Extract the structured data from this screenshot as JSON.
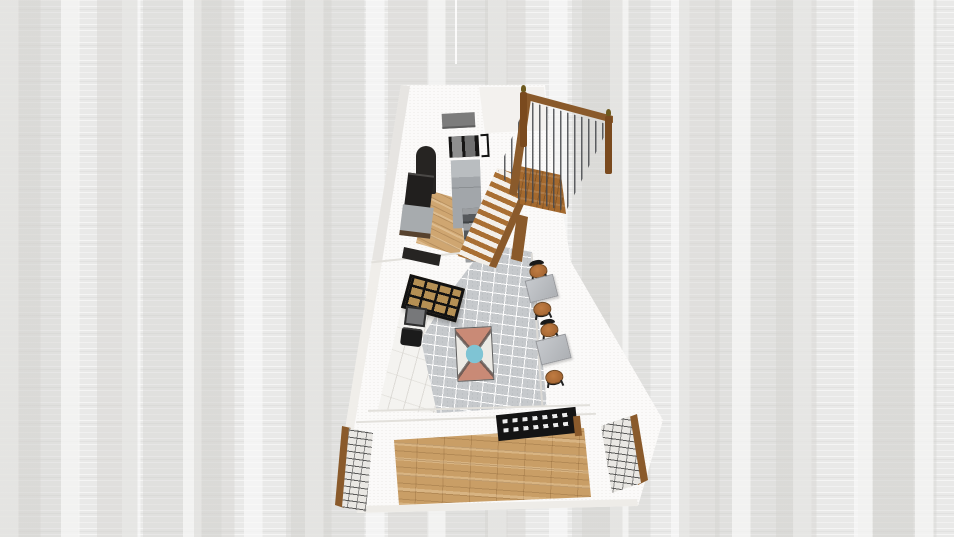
{
  "scene": {
    "title": "3D floor plan render",
    "view": "elevated three-quarter perspective of a narrow two-level unit",
    "rooms": [
      {
        "label": "kitchen"
      },
      {
        "label": "stair hall"
      },
      {
        "label": "dining walkway"
      },
      {
        "label": "entry porch"
      }
    ],
    "colors": {
      "background": "#e9e9e8",
      "building_white": "#fbfaf9",
      "exterior_shadow": "#e7e5e2",
      "exterior_shadow_light": "#f0eeea",
      "back_wall_shade": "#f3f1ee",
      "window_panel_gray": "#7c7c7c",
      "appliance_black": "#161514",
      "cabinet_dark": "#262422",
      "counter_black": "#211f1e",
      "cabinet_gray": "#a7abae",
      "fridge_gray": "#a2a6aa",
      "appliance_counter_gray": "#55585b",
      "kitchen_wood": "#cfa671",
      "stair_tread_wood": "#a96f33",
      "stair_stringer_wood": "#8a5a2b",
      "landing_wood": "#a4692e",
      "rail_wood": "#8a5a2b",
      "newel_wood": "#7a4a1e",
      "finial_bronze": "#6e5a1e",
      "door_glass_tan": "#b59054",
      "door_frame_black": "#121212",
      "console_gray": "#77787a",
      "armchair_black": "#1b1b1b",
      "marble_white": "#f4f3f0",
      "tile_gray": "#c6c9cc",
      "rug_base": "#eceae5",
      "rug_teal": "#7fc4d4",
      "rug_coral": "#c98a76",
      "table_gray": "#bcbfc3",
      "chair_seat_wood": "#ad6d38",
      "chair_back_black": "#191919",
      "entry_wood": "#c99e66",
      "bench_black": "#141414",
      "pillar_brick_fill": "#e9e7e3",
      "pillar_wood_trim": "#8a5a2b"
    },
    "objects": {
      "building": {
        "label": "building footprint"
      },
      "wall_art": {
        "label": "wall panel / window"
      },
      "wall_oven": {
        "label": "wall oven / microwave"
      },
      "oven_bracket": {
        "label": "wall bracket"
      },
      "arched_cabinet": {
        "label": "arched pantry cabinet"
      },
      "kitchen_counter": {
        "label": "dark kitchen counter"
      },
      "base_cabinet": {
        "label": "gray base cabinet"
      },
      "lower_counter": {
        "label": "lower counter run"
      },
      "refrigerator": {
        "label": "refrigerator / tall unit"
      },
      "appliance_counter": {
        "label": "counter with appliances"
      },
      "kitchen_wood_floor": {
        "label": "kitchen wood floor"
      },
      "staircase": {
        "label": "staircase flight"
      },
      "stair_stringer": {
        "label": "stair stringer"
      },
      "landing": {
        "label": "stair landing"
      },
      "railing": {
        "label": "stair railing balusters"
      },
      "top_rail": {
        "label": "handrail"
      },
      "side_rail": {
        "label": "lower handrail"
      },
      "newel_left": {
        "label": "newel post with finial"
      },
      "newel_right": {
        "label": "newel post with finial"
      },
      "glass_door": {
        "label": "black-framed glass door"
      },
      "console_table": {
        "label": "console table"
      },
      "armchair": {
        "label": "black armchair"
      },
      "marble_floor": {
        "label": "marble floor"
      },
      "tile_walkway": {
        "label": "gray tile walkway"
      },
      "area_rug": {
        "label": "patterned area rug"
      },
      "dining_table_1": {
        "label": "dining table"
      },
      "dining_table_2": {
        "label": "dining table"
      },
      "dining_chair_1": {
        "label": "dining chair"
      },
      "dining_chair_2": {
        "label": "dining chair"
      },
      "dining_chair_3": {
        "label": "dining chair"
      },
      "dining_chair_4": {
        "label": "dining chair"
      },
      "entry_wood_floor": {
        "label": "entry wood plank floor"
      },
      "slatted_bench": {
        "label": "black slatted bench"
      },
      "bench_side": {
        "label": "bench side panel"
      },
      "stone_pillar_left": {
        "label": "stone pillar left"
      },
      "stone_pillar_right": {
        "label": "stone pillar right"
      }
    }
  }
}
